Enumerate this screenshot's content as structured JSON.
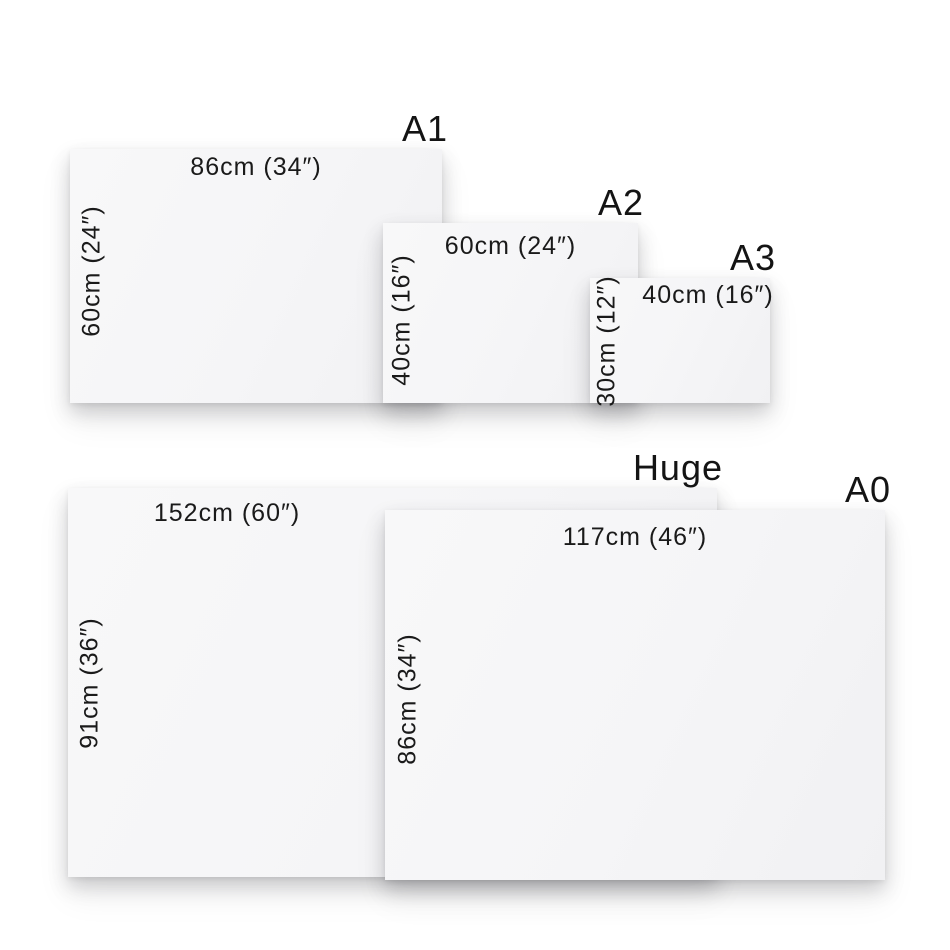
{
  "colors": {
    "background": "#ffffff",
    "panel_fill": "#f6f6f7",
    "text": "#1a1a1a"
  },
  "panels": [
    {
      "id": "a1",
      "label": "A1",
      "width_label": "86cm (34″)",
      "height_label": "60cm (24″)",
      "width_cm": 86,
      "width_in": 34,
      "height_cm": 60,
      "height_in": 24
    },
    {
      "id": "a2",
      "label": "A2",
      "width_label": "60cm (24″)",
      "height_label": "40cm (16″)",
      "width_cm": 60,
      "width_in": 24,
      "height_cm": 40,
      "height_in": 16
    },
    {
      "id": "a3",
      "label": "A3",
      "width_label": "40cm (16″)",
      "height_label": "30cm (12″)",
      "width_cm": 40,
      "width_in": 16,
      "height_cm": 30,
      "height_in": 12
    },
    {
      "id": "huge",
      "label": "Huge",
      "width_label": "152cm (60″)",
      "height_label": "91cm (36″)",
      "width_cm": 152,
      "width_in": 60,
      "height_cm": 91,
      "height_in": 36
    },
    {
      "id": "a0",
      "label": "A0",
      "width_label": "117cm (46″)",
      "height_label": "86cm (34″)",
      "width_cm": 117,
      "width_in": 46,
      "height_cm": 86,
      "height_in": 34
    }
  ]
}
